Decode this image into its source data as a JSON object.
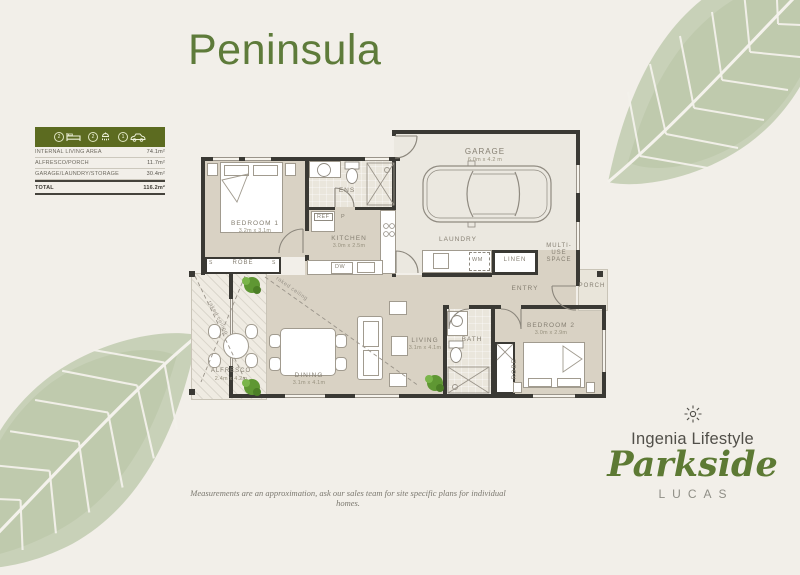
{
  "page": {
    "title": "Peninsula",
    "disclaimer": "Measurements are an approximation, ask our sales team for site specific plans for individual homes."
  },
  "colors": {
    "accent_green": "#5d7a36",
    "table_header_green": "#5c6b20",
    "wall": "#3a3934",
    "floor_beige": "#d9d2c4",
    "background": "#f2efe9",
    "leaf_sage": "#c3cdb3"
  },
  "area_table": {
    "header_icons": [
      {
        "count": "2",
        "icon": "bed-icon"
      },
      {
        "count": "2",
        "icon": "shower-icon"
      },
      {
        "count": "1",
        "icon": "car-icon"
      }
    ],
    "rows": [
      {
        "label": "INTERNAL LIVING AREA",
        "value": "74.1m²"
      },
      {
        "label": "ALFRESCO/PORCH",
        "value": "11.7m²"
      },
      {
        "label": "GARAGE/LAUNDRY/STORAGE",
        "value": "30.4m²"
      }
    ],
    "total": {
      "label": "TOTAL",
      "value": "116.2m²"
    }
  },
  "floorplan": {
    "rooms": {
      "garage": {
        "name": "GARAGE",
        "dims": "6.0m x 4.2 m"
      },
      "bedroom1": {
        "name": "BEDROOM 1",
        "dims": "3.2m x 3.1m"
      },
      "ens": {
        "name": "ENS"
      },
      "kitchen": {
        "name": "KITCHEN",
        "dims": "3.0m x 2.5m"
      },
      "laundry": {
        "name": "LAUNDRY"
      },
      "linen": {
        "name": "LINEN"
      },
      "multiuse": {
        "name": "MULTI-USE SPACE"
      },
      "entry": {
        "name": "ENTRY"
      },
      "porch": {
        "name": "PORCH"
      },
      "bedroom2": {
        "name": "BEDROOM 2",
        "dims": "3.0m x 2.9m"
      },
      "bath": {
        "name": "BATH"
      },
      "robe1": {
        "name": "ROBE"
      },
      "robe2": {
        "name": "ROBE"
      },
      "living": {
        "name": "LIVING",
        "dims": "3.1m x 4.1m"
      },
      "dining": {
        "name": "DINING",
        "dims": "3.1m x 4.1m"
      },
      "alfresco": {
        "name": "ALFRESCO",
        "dims": "2.4m x 4.2m"
      }
    },
    "fixtures": {
      "ref": "REF",
      "pantry": "P",
      "dw": "DW",
      "wm": "WM",
      "sliding": "S"
    },
    "annotations": {
      "raked1": "raked ceiling",
      "raked2": "raked ceiling"
    }
  },
  "logo": {
    "brand": "Ingenia Lifestyle",
    "community": "Parkside",
    "suburb": "LUCAS"
  }
}
